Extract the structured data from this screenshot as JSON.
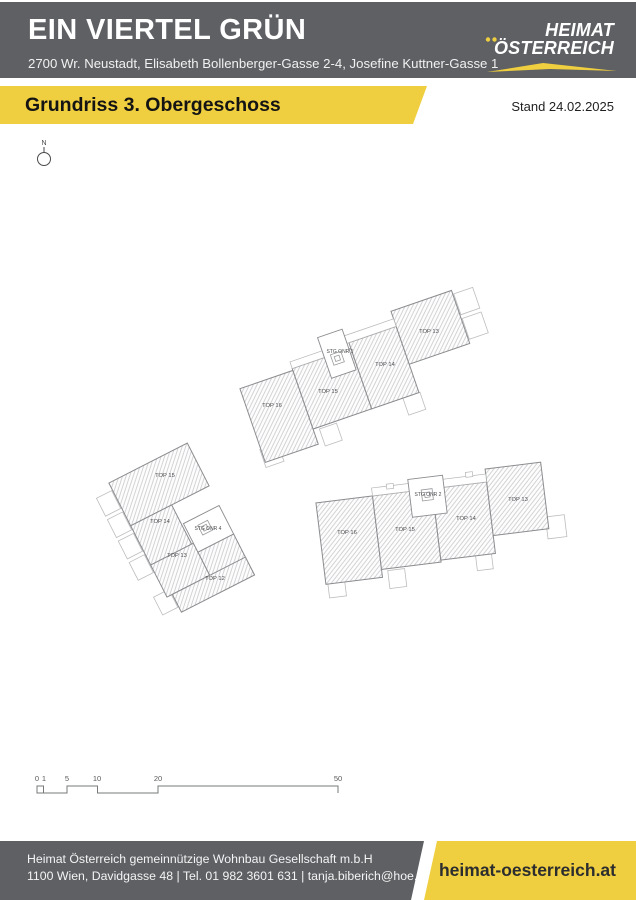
{
  "colors": {
    "header_bg": "#5e6064",
    "accent_yellow": "#efce3f",
    "plan_line": "#8b8c8f"
  },
  "header": {
    "title": "EIN VIERTEL GRÜN",
    "address": "2700 Wr. Neustadt, Elisabeth Bollenberger-Gasse 2-4, Josefine Kuttner-Gasse 1",
    "logo_line1": "HEIMAT",
    "logo_line2": "ÖSTERREICH"
  },
  "banner": {
    "title": "Grundriss 3. Obergeschoss",
    "stand": "Stand 24.02.2025"
  },
  "compass": {
    "north_label": "N"
  },
  "plan": {
    "stiege1": {
      "stairwell": "STG ONR 1",
      "top16": "TOP 16",
      "top15": "TOP 15",
      "top14": "TOP 14",
      "top13": "TOP 13"
    },
    "stiege2": {
      "stairwell": "STG ONR 2",
      "top16": "TOP 16",
      "top15": "TOP 15",
      "top14": "TOP 14",
      "top13": "TOP 13"
    },
    "stiege4": {
      "stairwell": "STG ONR 4",
      "top15": "TOP 15",
      "top14": "TOP 14",
      "top13": "TOP 13",
      "top12": "TOP 12"
    }
  },
  "scalebar": {
    "l0": "0",
    "l1": "1",
    "l5": "5",
    "l10": "10",
    "l20": "20",
    "l50": "50"
  },
  "footer": {
    "company": "Heimat Österreich gemeinnützige Wohnbau Gesellschaft m.b.H",
    "contact": "1100 Wien, Davidgasse 48 | Tel. 01 982 3601 631 | tanja.biberich@hoe.at",
    "website": "heimat-oesterreich.at"
  }
}
